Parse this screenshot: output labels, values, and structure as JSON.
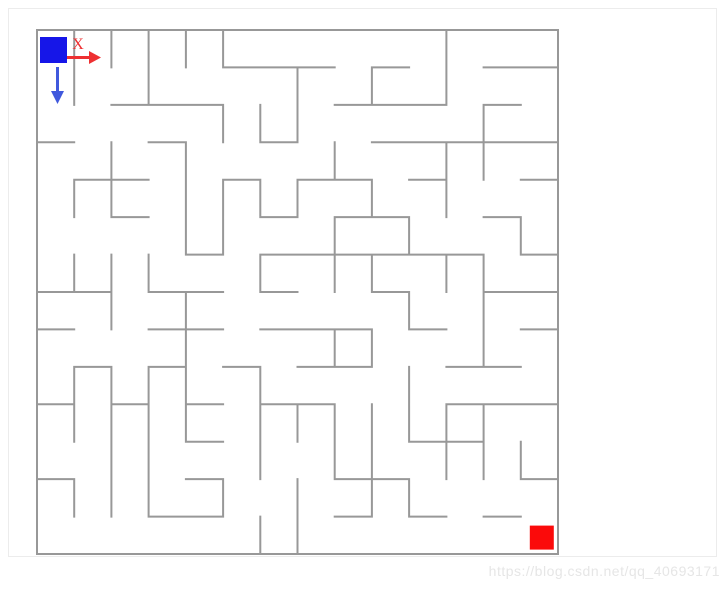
{
  "page": {
    "background": "#ffffff",
    "frame_color": "#ececec"
  },
  "watermark": {
    "text": "https://blog.csdn.net/qq_40693171",
    "color": "#e6e6e6"
  },
  "maze": {
    "cols": 14,
    "rows": 14,
    "wall_color": "#989898",
    "wall_width": 2,
    "h_walls": [
      [
        0,
        1,
        2,
        3,
        4,
        5,
        6,
        7,
        8,
        9,
        10,
        11,
        12,
        13
      ],
      [
        5,
        6,
        7,
        9,
        12,
        13
      ],
      [
        2,
        3,
        4,
        8,
        9,
        10,
        12
      ],
      [
        0,
        3,
        6,
        9,
        10,
        11,
        12,
        13
      ],
      [
        1,
        2,
        5,
        7,
        8,
        10,
        13
      ],
      [
        2,
        6,
        8,
        9,
        12
      ],
      [
        4,
        6,
        7,
        8,
        9,
        10,
        11,
        13
      ],
      [
        0,
        1,
        3,
        4,
        6,
        9,
        12,
        13
      ],
      [
        0,
        3,
        4,
        6,
        7,
        8,
        10,
        13
      ],
      [
        1,
        3,
        5,
        7,
        8,
        11,
        12
      ],
      [
        0,
        2,
        4,
        6,
        7,
        11,
        12,
        13
      ],
      [
        4,
        10,
        11
      ],
      [
        0,
        4,
        8,
        9,
        13
      ],
      [
        3,
        4,
        8,
        10,
        12
      ],
      [
        0,
        1,
        2,
        3,
        4,
        5,
        6,
        7,
        8,
        9,
        10,
        11,
        12,
        13
      ]
    ],
    "v_walls": [
      [
        0,
        1,
        2,
        3,
        4,
        5,
        11,
        14
      ],
      [
        0,
        1,
        3,
        7,
        9,
        11,
        14
      ],
      [
        0,
        5,
        6,
        7,
        12,
        14
      ],
      [
        0,
        2,
        4,
        8,
        11,
        12,
        14
      ],
      [
        0,
        1,
        2,
        4,
        5,
        6,
        7,
        9,
        11,
        14
      ],
      [
        0,
        4,
        5,
        8,
        10,
        13,
        14
      ],
      [
        0,
        1,
        2,
        3,
        6,
        8,
        9,
        11,
        12,
        14
      ],
      [
        0,
        2,
        4,
        10,
        12,
        14
      ],
      [
        0,
        4,
        8,
        9,
        12,
        14
      ],
      [
        0,
        1,
        2,
        3,
        4,
        6,
        10,
        14
      ],
      [
        0,
        1,
        2,
        3,
        4,
        6,
        7,
        8,
        9,
        10,
        11,
        12,
        14
      ],
      [
        0,
        2,
        3,
        6,
        8,
        9,
        11,
        12,
        13,
        14
      ],
      [
        0,
        1,
        2,
        3,
        5,
        7,
        9,
        10,
        14
      ],
      [
        0,
        6,
        7,
        14
      ]
    ],
    "start": {
      "col": 0,
      "row": 0,
      "color": "#1616e8"
    },
    "goal": {
      "col": 13,
      "row": 13,
      "color": "#fb0a0a"
    },
    "axes": {
      "x_label": "X",
      "x_color": "#ee3032",
      "y_color": "#4059dd"
    }
  }
}
